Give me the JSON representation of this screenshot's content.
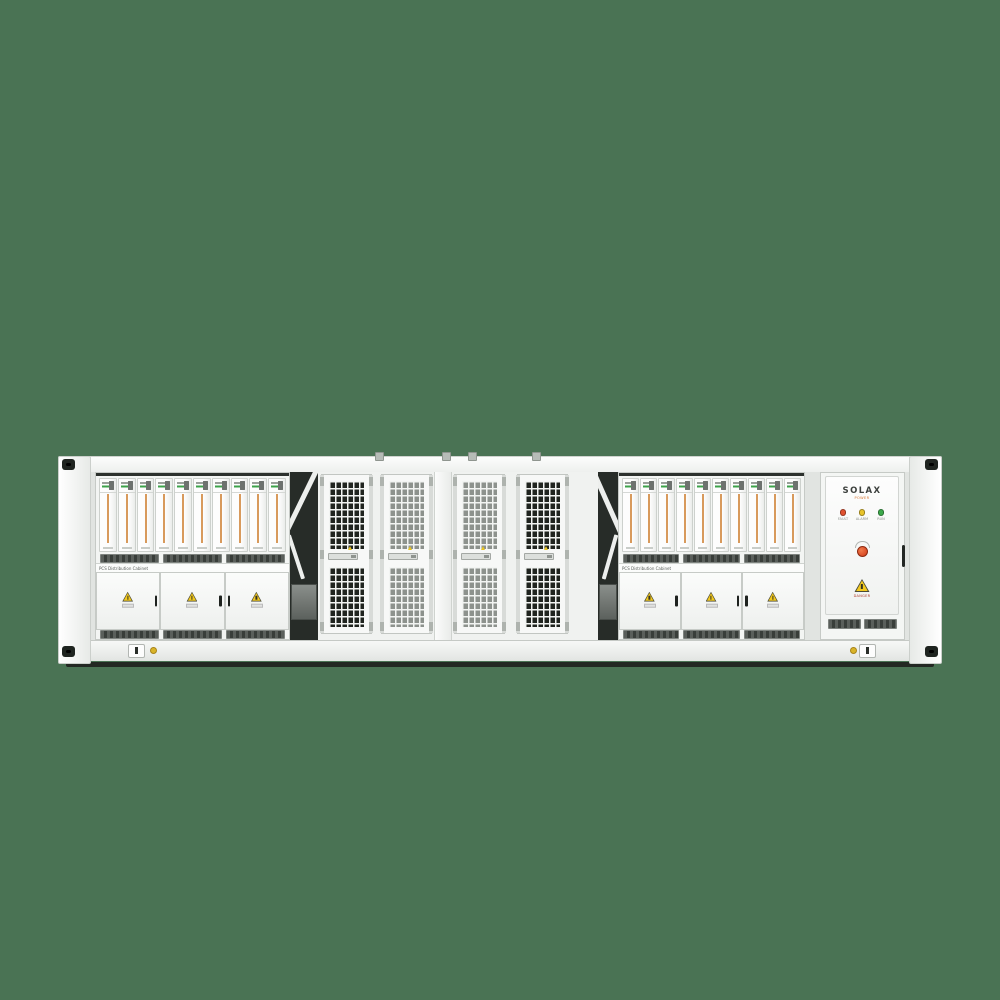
{
  "scene": {
    "description": "Front elevation render of a white containerized battery energy storage system on a plain green background",
    "background_color": "#4a7354"
  },
  "container": {
    "body_color": "#f3f5f3",
    "frame_color": "#cfd3cf",
    "left_rack": {
      "pcs_label": "PCS Distribution Cabinet",
      "battery_module_count": 10,
      "door_count": 3
    },
    "right_rack": {
      "pcs_label": "PCS Distribution Cabinet",
      "battery_module_count": 10,
      "door_count": 3
    },
    "mesh_section": {
      "door_count": 4
    },
    "solax_cabinet": {
      "brand": "SOLAX",
      "brand_tagline": "POWER",
      "leds": [
        {
          "label": "FAULT",
          "color": "#e0502e"
        },
        {
          "label": "ALARM",
          "color": "#e8c32a"
        },
        {
          "label": "RUN",
          "color": "#3ca94a"
        }
      ],
      "danger_label": "DANGER"
    },
    "colors": {
      "battery_stripe_orange": "#d89a5c",
      "warning_yellow": "#f2c81e",
      "estop_red": "#d23a18",
      "mesh_hole_dark": "#20241f",
      "mesh_hole_light": "#8d928d",
      "vent_dark": "#393e3a"
    }
  }
}
